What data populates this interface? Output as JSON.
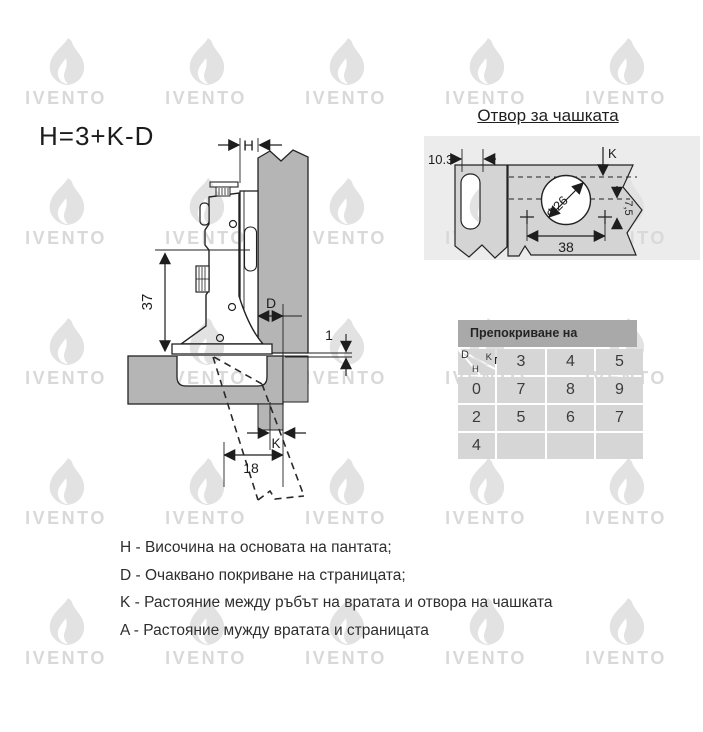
{
  "formula": "H=3+K-D",
  "watermark": {
    "text": "IVENTO"
  },
  "cup_hole": {
    "title": "Отвор за чашката",
    "dims": {
      "panel_width": "10.3",
      "k": "K",
      "diameter": "Φ26",
      "screw_distance": "38",
      "offset": "7,5"
    }
  },
  "main_drawing": {
    "dims": {
      "h": "H",
      "height": "37",
      "d": "D",
      "gap": "1",
      "k": "K",
      "depth": "18"
    }
  },
  "table": {
    "title": "Препокриване на вратичката",
    "corner": {
      "d": "D",
      "k": "K",
      "h": "H"
    },
    "columns": [
      "3",
      "4",
      "5"
    ],
    "rows": [
      {
        "h": "0",
        "values": [
          "7",
          "8",
          "9"
        ]
      },
      {
        "h": "2",
        "values": [
          "5",
          "6",
          "7"
        ]
      },
      {
        "h": "4",
        "values": [
          "",
          "",
          ""
        ]
      }
    ]
  },
  "legend": [
    "H - Височина на основата на пантата;",
    "D - Очаквано покриване на страницата;",
    "K - Растояние между ръбът на вратата и отвора на чашката",
    "A - Растояние мужду вратата и страницата"
  ]
}
